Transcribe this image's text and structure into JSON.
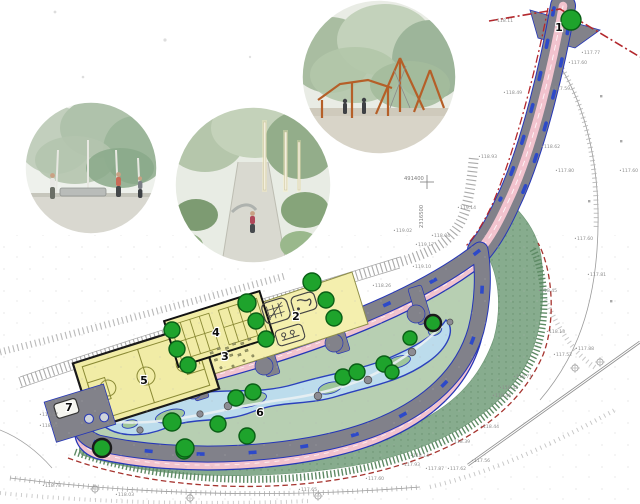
{
  "plan": {
    "zone_labels": [
      {
        "n": "1",
        "x": 559,
        "y": 31
      },
      {
        "n": "2",
        "x": 296,
        "y": 320
      },
      {
        "n": "3",
        "x": 225,
        "y": 360
      },
      {
        "n": "4",
        "x": 216,
        "y": 336
      },
      {
        "n": "5",
        "x": 144,
        "y": 384
      },
      {
        "n": "6",
        "x": 260,
        "y": 416
      },
      {
        "n": "7",
        "x": 69,
        "y": 411
      }
    ],
    "grid_refs": [
      {
        "t": "491400",
        "x": 404,
        "y": 180,
        "rot": 0
      },
      {
        "t": "2316500",
        "x": 423,
        "y": 228,
        "rot": -90
      }
    ],
    "elevations": [
      {
        "t": "118.11",
        "x": 497,
        "y": 22
      },
      {
        "t": "117.77",
        "x": 584,
        "y": 54
      },
      {
        "t": "117.60",
        "x": 571,
        "y": 64
      },
      {
        "t": "117.59",
        "x": 554,
        "y": 90
      },
      {
        "t": "118.49",
        "x": 506,
        "y": 94
      },
      {
        "t": "118.62",
        "x": 544,
        "y": 148
      },
      {
        "t": "117.80",
        "x": 558,
        "y": 172
      },
      {
        "t": "118.93",
        "x": 481,
        "y": 158
      },
      {
        "t": "117.60",
        "x": 622,
        "y": 172
      },
      {
        "t": "119.14",
        "x": 460,
        "y": 209
      },
      {
        "t": "117.60",
        "x": 577,
        "y": 240
      },
      {
        "t": "118.04",
        "x": 434,
        "y": 237
      },
      {
        "t": "119.17",
        "x": 418,
        "y": 246
      },
      {
        "t": "119.02",
        "x": 396,
        "y": 232
      },
      {
        "t": "119.10",
        "x": 415,
        "y": 268
      },
      {
        "t": "118.26",
        "x": 375,
        "y": 287
      },
      {
        "t": "117.81",
        "x": 590,
        "y": 276
      },
      {
        "t": "118.45",
        "x": 541,
        "y": 292
      },
      {
        "t": "118.13",
        "x": 549,
        "y": 333
      },
      {
        "t": "117.52",
        "x": 556,
        "y": 356
      },
      {
        "t": "117.88",
        "x": 578,
        "y": 350
      },
      {
        "t": "118.87",
        "x": 42,
        "y": 416
      },
      {
        "t": "118.95",
        "x": 42,
        "y": 427
      },
      {
        "t": "118.73",
        "x": 45,
        "y": 487
      },
      {
        "t": "118.03",
        "x": 118,
        "y": 496
      },
      {
        "t": "117.60",
        "x": 368,
        "y": 480
      },
      {
        "t": "117.65",
        "x": 301,
        "y": 491
      },
      {
        "t": "118.14",
        "x": 413,
        "y": 457
      },
      {
        "t": "117.93",
        "x": 404,
        "y": 466
      },
      {
        "t": "117.87",
        "x": 428,
        "y": 470
      },
      {
        "t": "117.62",
        "x": 450,
        "y": 470
      },
      {
        "t": "117.56",
        "x": 474,
        "y": 462
      },
      {
        "t": "118.39",
        "x": 454,
        "y": 443
      },
      {
        "t": "118.44",
        "x": 483,
        "y": 428
      },
      {
        "t": "118.46",
        "x": 495,
        "y": 397
      },
      {
        "t": "118.42",
        "x": 502,
        "y": 389
      },
      {
        "t": "118.71",
        "x": 516,
        "y": 378
      }
    ],
    "trees": [
      {
        "x": 571,
        "y": 20,
        "r": 10
      },
      {
        "x": 247,
        "y": 303,
        "r": 9
      },
      {
        "x": 312,
        "y": 282,
        "r": 9
      },
      {
        "x": 326,
        "y": 300,
        "r": 8
      },
      {
        "x": 334,
        "y": 318,
        "r": 8
      },
      {
        "x": 256,
        "y": 321,
        "r": 8
      },
      {
        "x": 266,
        "y": 339,
        "r": 8
      },
      {
        "x": 177,
        "y": 349,
        "r": 8
      },
      {
        "x": 188,
        "y": 365,
        "r": 8
      },
      {
        "x": 172,
        "y": 330,
        "r": 8
      },
      {
        "x": 253,
        "y": 392,
        "r": 8
      },
      {
        "x": 236,
        "y": 398,
        "r": 8
      },
      {
        "x": 172,
        "y": 422,
        "r": 9
      },
      {
        "x": 218,
        "y": 424,
        "r": 8
      },
      {
        "x": 247,
        "y": 436,
        "r": 8
      },
      {
        "x": 184,
        "y": 451,
        "r": 8
      },
      {
        "x": 102,
        "y": 448,
        "r": 9,
        "ring": true
      },
      {
        "x": 185,
        "y": 448,
        "r": 9
      },
      {
        "x": 343,
        "y": 377,
        "r": 8
      },
      {
        "x": 357,
        "y": 372,
        "r": 8
      },
      {
        "x": 384,
        "y": 364,
        "r": 8
      },
      {
        "x": 392,
        "y": 372,
        "r": 7
      },
      {
        "x": 433,
        "y": 323,
        "r": 8,
        "ring": true
      },
      {
        "x": 410,
        "y": 338,
        "r": 7
      }
    ],
    "survey_trees": [
      {
        "x": 575,
        "y": 368
      },
      {
        "x": 600,
        "y": 362
      },
      {
        "x": 95,
        "y": 489
      },
      {
        "x": 190,
        "y": 498
      },
      {
        "x": 318,
        "y": 496
      }
    ]
  },
  "photos": [
    {
      "name": "birch-plaza-people"
    },
    {
      "name": "playground-path-lamps"
    },
    {
      "name": "rope-climbing-playground"
    }
  ],
  "colors": {
    "bike_lane_pink": "#f2c3ce",
    "walkway_gray": "#81818a",
    "edge_blue": "#2536b8",
    "bench_blue": "#2d49c9",
    "sport_yellow": "#f4efae",
    "court_line": "#8a8a35",
    "lawn_green": "#87ac8e",
    "hatch_green": "#5d8a64",
    "play_blue": "#bcdcec",
    "island_green": "#9fc69b",
    "tree_green": "#1ea32c",
    "boundary_red": "#b3282d",
    "survey_gray": "#9b9b9b"
  }
}
